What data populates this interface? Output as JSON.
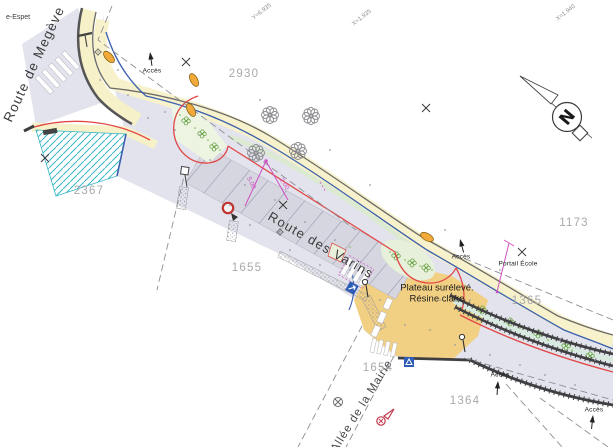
{
  "plan": {
    "street_labels": {
      "megeve": "Route de Megève",
      "varins": "Route des Varins",
      "mairie": "Allée de la Mairie"
    },
    "corner_label": "e-Espet",
    "parcels": {
      "p2930": "2930",
      "p2367": "2367",
      "p1655": "1655",
      "p1173": "1173",
      "p1365": "1365",
      "p1654": "1654",
      "p1364": "1364"
    },
    "annotations": {
      "acces": "Accès",
      "portail_ecole": "Portail École",
      "plateau_line1": "Plateau surélevé.",
      "plateau_line2": "Résine claire"
    },
    "dimensions": {
      "d1": "5.00",
      "d2": "2.00"
    },
    "grid_labels": {
      "g1": "Y=6.935",
      "g2": "X=1.935",
      "g3": "X=1.940"
    },
    "north_letter": "N",
    "legend_colors": {
      "road_surface": "#e2e3ec",
      "parking_stalls": "#d5d6e0",
      "sidewalk_yellow": "#f6f1c8",
      "plateau_resin": "#f2d083",
      "planting_green": "#e7f0da",
      "reserved_teal": "#35b6c6",
      "project_limit_red": "#e04848",
      "curb_blue": "#3a5fae",
      "dimension_magenta": "#cf4fc4",
      "marker_orange": "#f2a93b"
    }
  }
}
